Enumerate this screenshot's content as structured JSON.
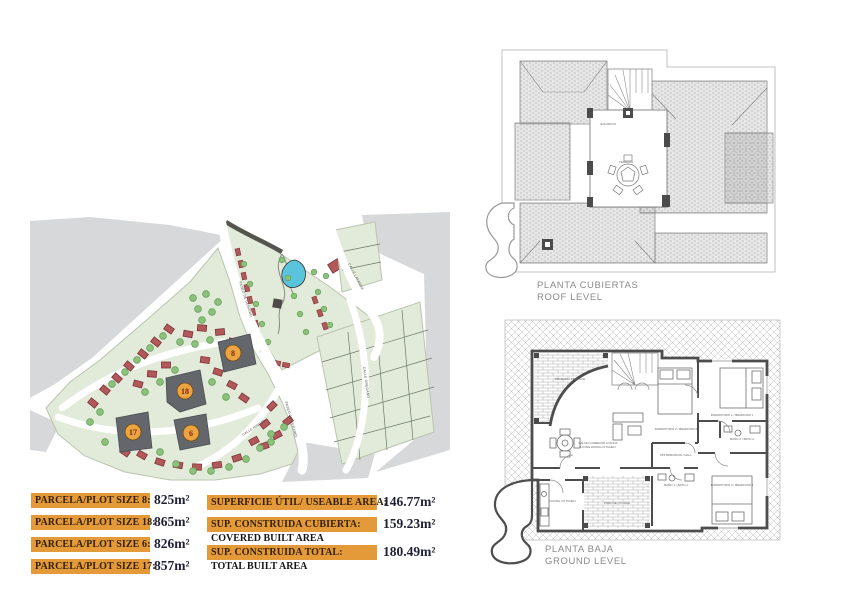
{
  "site_plan": {
    "plots": [
      {
        "number": "8"
      },
      {
        "number": "18"
      },
      {
        "number": "6"
      },
      {
        "number": "17"
      }
    ],
    "streets": [
      "PASEO DE GERANIO",
      "CALLE LAVANDA",
      "CALLE OREGANO",
      "CALLE HINOJO",
      "PASEO DE GERANIO"
    ],
    "colors": {
      "parcel_green": "#e2ebda",
      "house_red": "#b2575a",
      "house_outline": "#7d3538",
      "tree_green": "#8cc17c",
      "tree_outline": "#5f9a53",
      "pool_blue": "#5ac4dc",
      "road_gray": "#d7d8d9",
      "highlight_plot": "#63676b",
      "badge_orange": "#eba43f"
    }
  },
  "roof_plan": {
    "title_es": "PLANTA CUBIERTAS",
    "title_en": "ROOF LEVEL",
    "terrace_labels": [
      "SOLARIUM",
      "TERRAZA"
    ]
  },
  "ground_plan": {
    "title_es": "PLANTA BAJA",
    "title_en": "GROUND LEVEL",
    "rooms": [
      "TERRAZA / TERRACE",
      "SALON COMEDOR COCINA",
      "LIVING DINING KITCHEN",
      "DISTRIBUIDOR / HALL",
      "DORMITORIO 2 / BEDROOM 2",
      "DORMITORIO 1 / BEDROOM 1",
      "DORMITORIO 3 / BEDROOM 3",
      "BAÑO 2 / BATH 2",
      "BAÑO 1 / BATH 1",
      "COCINA / KITCHEN",
      "PORCHE / PORCH"
    ]
  },
  "area_table": {
    "plot_rows": [
      {
        "label": "PARCELA/PLOT SIZE 8:",
        "value": "825m²"
      },
      {
        "label": "PARCELA/PLOT SIZE 18:",
        "value": "865m²"
      },
      {
        "label": "PARCELA/PLOT SIZE 6:",
        "value": "826m²"
      },
      {
        "label": "PARCELA/PLOT SIZE 17:",
        "value": "857m²"
      }
    ],
    "area_rows": [
      {
        "label": "SUPERFICIE ÚTIL/ USEABLE AREA:",
        "value": "146.77m²",
        "sublabel": ""
      },
      {
        "label": "SUP. CONSTRUIDA CUBIERTA:",
        "value": "159.23m²",
        "sublabel": "COVERED BUILT AREA"
      },
      {
        "label": "SUP. CONSTRUIDA TOTAL:",
        "value": "180.49m²",
        "sublabel": "TOTAL BUILT AREA"
      }
    ],
    "colors": {
      "bar_orange": "#e49a39",
      "value_text": "#1f1f35"
    }
  }
}
